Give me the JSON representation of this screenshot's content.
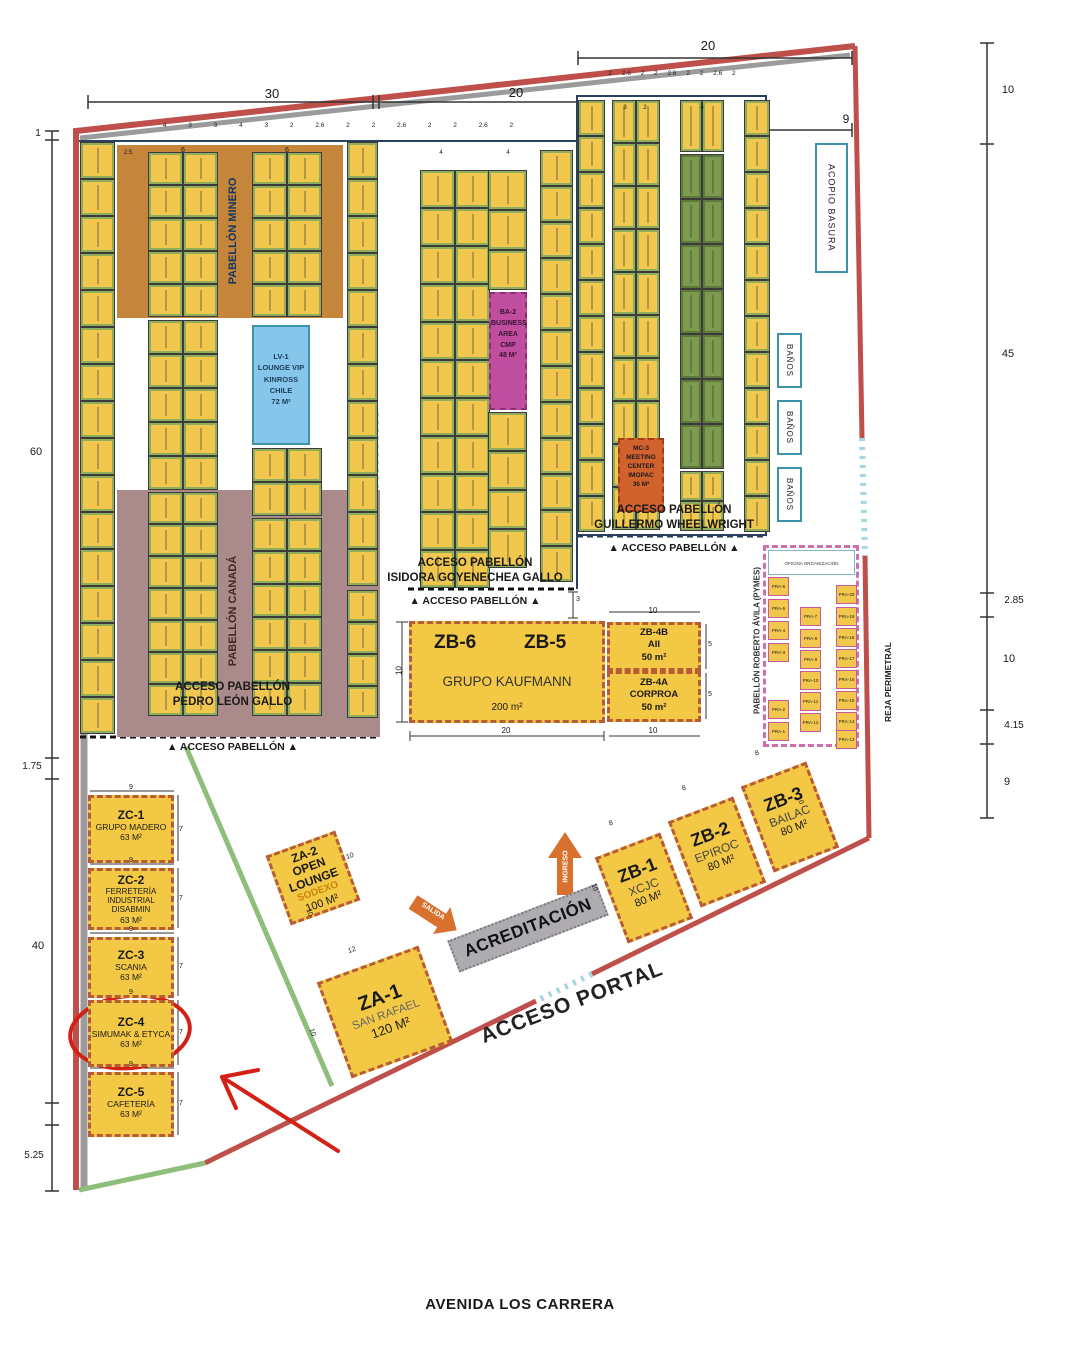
{
  "colors": {
    "perimeter_red": "#bf4f4a",
    "gray_band": "#9b9b9b",
    "green_fence": "#8ebf7a",
    "gate_blue": "#a5d6e4",
    "booth_yellow": "#f1c84d",
    "booth_green": "#7d9b4e",
    "pabellon_minero": "#c5863b",
    "pabellon_canada": "#ab8a8b",
    "lv1_blue": "#85c6ea",
    "ba2_magenta": "#bf4f9e",
    "mc3_orange": "#d2622d",
    "zone_yellow": "#f3c845",
    "zone_border": "#b85c38",
    "pymes_pink": "#d06fae",
    "teal": "#3f93a8",
    "navy": "#2d3f5e",
    "annotation_red": "#d42015",
    "arrow_orange": "#d8702e",
    "banner_gray": "#aeabb1"
  },
  "pavilions": {
    "minero": "PABELLÓN MINERO",
    "canada": "PABELLÓN CANADÁ",
    "pymes_label": "PABELLÓN ROBERTO ÁVILA (PYMES)",
    "pymes_office": "OFICINA ORGANIZACIÓN"
  },
  "blocks": {
    "lv1": "LV-1\nLOUNGE VIP\nKINROSS CHILE\n72 M²",
    "ba2": "BA-2\nBUSINESS\nAREA\nCMP\n48 M²",
    "mc3": "MC-3\nMEETING\nCENTER\nIMOPAC\n36 M²"
  },
  "zones": {
    "zb6": "ZB-6",
    "zb5": "ZB-5",
    "kaufmann_name": "GRUPO KAUFMANN",
    "kaufmann_area": "200 m²",
    "zb4b": "ZB-4B\nAII\n50 m²",
    "zb4a": "ZB-4A\nCORPROA\n50 m²",
    "zb123": [
      {
        "id": "ZB-1",
        "name": "XCJC",
        "area": "80 M²"
      },
      {
        "id": "ZB-2",
        "name": "EPIROC",
        "area": "80 M²"
      },
      {
        "id": "ZB-3",
        "name": "BAILAC",
        "area": "80 M²"
      }
    ],
    "za2": {
      "id": "ZA-2",
      "name": "OPEN\nLOUNGE",
      "brand": "SODEXO",
      "area": "100 M²"
    },
    "za1": {
      "id": "ZA-1",
      "name": "SAN RAFAEL",
      "area": "120 M²"
    },
    "zc": [
      {
        "id": "ZC-1",
        "name": "GRUPO MADERO",
        "area": "63 M²"
      },
      {
        "id": "ZC-2",
        "name": "FERRETERÍA INDUSTRIAL DISABMIN",
        "area": "63 M²"
      },
      {
        "id": "ZC-3",
        "name": "SCANIA",
        "area": "63 M²"
      },
      {
        "id": "ZC-4",
        "name": "SIMUMAK & ETYCA",
        "area": "63 M²"
      },
      {
        "id": "ZC-5",
        "name": "CAFETERÍA",
        "area": "63 M²"
      }
    ]
  },
  "pymes_booths": [
    {
      "id": "PRA-6",
      "x": 768,
      "y": 577
    },
    {
      "id": "PRA-5",
      "x": 768,
      "y": 599
    },
    {
      "id": "PRA-4",
      "x": 768,
      "y": 621
    },
    {
      "id": "PRA-3",
      "x": 768,
      "y": 643
    },
    {
      "id": "PRA-2",
      "x": 768,
      "y": 700
    },
    {
      "id": "PRA-1",
      "x": 768,
      "y": 722
    },
    {
      "id": "PRA-7",
      "x": 800,
      "y": 607
    },
    {
      "id": "PRA-8",
      "x": 800,
      "y": 629
    },
    {
      "id": "PRA-9",
      "x": 800,
      "y": 650
    },
    {
      "id": "PRA-10",
      "x": 800,
      "y": 671
    },
    {
      "id": "PRA-11",
      "x": 800,
      "y": 692
    },
    {
      "id": "PRA-12",
      "x": 800,
      "y": 713
    },
    {
      "id": "PRA-20",
      "x": 836,
      "y": 585
    },
    {
      "id": "PRA-19",
      "x": 836,
      "y": 607
    },
    {
      "id": "PRA-18",
      "x": 836,
      "y": 628
    },
    {
      "id": "PRA-17",
      "x": 836,
      "y": 649
    },
    {
      "id": "PRA-16",
      "x": 836,
      "y": 670
    },
    {
      "id": "PRA-15",
      "x": 836,
      "y": 691
    },
    {
      "id": "PRA-14",
      "x": 836,
      "y": 712
    },
    {
      "id": "PRA-13",
      "x": 836,
      "y": 730
    }
  ],
  "facilities": {
    "acopio": "ACOPIO BASURA",
    "banos": [
      "BAÑOS",
      "BAÑOS",
      "BAÑOS"
    ]
  },
  "accesses": {
    "guillermo": "ACCESO PABELLÓN\nGUILLERMO WHEELWRIGHT",
    "isidora": "ACCESO PABELLÓN\nISIDORA GOYENECHEA GALLO",
    "pedro": "ACCESO PABELLÓN\nPEDRO LEÓN GALLO",
    "marker": "▲ ACCESO PABELLÓN ▲"
  },
  "wayfinding": {
    "acreditacion": "ACREDITACIÓN",
    "salida": "SALIDA",
    "ingreso": "INGRESO",
    "acceso_portal": "ACCESO PORTAL",
    "avenida": "AVENIDA LOS CARRERA",
    "reja": "REJA PERIMETRAL"
  },
  "map": {
    "small_dim_row_left": "4 3 3 4 3 2 2.6 2 2 2.6 2 2 2.6 2",
    "small_dim_row_right": "2 2.6 2 2 2.6 2 2 2.6 2",
    "dim_labels": [
      {
        "t": "30",
        "x": 232,
        "y": 86,
        "fs": 13
      },
      {
        "t": "20",
        "x": 476,
        "y": 85,
        "fs": 13
      },
      {
        "t": "20",
        "x": 668,
        "y": 38,
        "fs": 13
      },
      {
        "t": "9",
        "x": 806,
        "y": 112,
        "fs": 12
      },
      {
        "t": "1",
        "x": -2,
        "y": 128,
        "fs": 10
      },
      {
        "t": "60",
        "x": -4,
        "y": 446,
        "fs": 11
      },
      {
        "t": "1.75",
        "x": -8,
        "y": 761,
        "fs": 10
      },
      {
        "t": "40",
        "x": -2,
        "y": 940,
        "fs": 11
      },
      {
        "t": "5.25",
        "x": -6,
        "y": 1150,
        "fs": 10
      },
      {
        "t": "10",
        "x": 968,
        "y": 84,
        "fs": 11
      },
      {
        "t": "45",
        "x": 968,
        "y": 348,
        "fs": 11
      },
      {
        "t": "2.85",
        "x": 974,
        "y": 595,
        "fs": 10
      },
      {
        "t": "10",
        "x": 969,
        "y": 653,
        "fs": 11
      },
      {
        "t": "4.15",
        "x": 974,
        "y": 720,
        "fs": 10
      },
      {
        "t": "9",
        "x": 967,
        "y": 776,
        "fs": 11
      },
      {
        "t": "2.5",
        "x": 88,
        "y": 150,
        "fs": 6
      },
      {
        "t": "6",
        "x": 143,
        "y": 147,
        "fs": 7
      },
      {
        "t": "6",
        "x": 247,
        "y": 147,
        "fs": 7
      },
      {
        "t": "4",
        "x": 401,
        "y": 150,
        "fs": 6
      },
      {
        "t": "4",
        "x": 468,
        "y": 150,
        "fs": 6
      },
      {
        "t": "3",
        "x": 585,
        "y": 105,
        "fs": 6
      },
      {
        "t": "2",
        "x": 605,
        "y": 105,
        "fs": 6
      },
      {
        "t": "4",
        "x": 662,
        "y": 105,
        "fs": 6
      },
      {
        "t": "3",
        "x": 538,
        "y": 596,
        "fs": 7
      },
      {
        "t": "10",
        "x": 359,
        "y": 666,
        "r": -90,
        "fs": 8
      },
      {
        "t": "20",
        "x": 466,
        "y": 726,
        "fs": 8
      },
      {
        "t": "10",
        "x": 613,
        "y": 606,
        "fs": 8
      },
      {
        "t": "5",
        "x": 670,
        "y": 641,
        "fs": 7
      },
      {
        "t": "5",
        "x": 670,
        "y": 691,
        "fs": 7
      },
      {
        "t": "10",
        "x": 613,
        "y": 726,
        "fs": 8
      },
      {
        "t": "8",
        "x": 571,
        "y": 820,
        "r": -21,
        "fs": 7
      },
      {
        "t": "8",
        "x": 644,
        "y": 785,
        "r": -21,
        "fs": 7
      },
      {
        "t": "8",
        "x": 717,
        "y": 750,
        "r": -21,
        "fs": 7
      },
      {
        "t": "10",
        "x": 554,
        "y": 884,
        "r": 69,
        "fs": 7
      },
      {
        "t": "10",
        "x": 760,
        "y": 797,
        "r": 69,
        "fs": 7
      },
      {
        "t": "10",
        "x": 310,
        "y": 853,
        "r": -20,
        "fs": 7
      },
      {
        "t": "10",
        "x": 269,
        "y": 909,
        "r": 70,
        "fs": 7
      },
      {
        "t": "12",
        "x": 312,
        "y": 947,
        "r": -20,
        "fs": 7
      },
      {
        "t": "10",
        "x": 272,
        "y": 1029,
        "r": 70,
        "fs": 7
      },
      {
        "t": "9",
        "x": 91,
        "y": 784,
        "fs": 7
      },
      {
        "t": "7",
        "x": 141,
        "y": 826,
        "fs": 7
      },
      {
        "t": "9",
        "x": 91,
        "y": 857,
        "fs": 7
      },
      {
        "t": "7",
        "x": 141,
        "y": 895,
        "fs": 7
      },
      {
        "t": "9",
        "x": 91,
        "y": 926,
        "fs": 7
      },
      {
        "t": "7",
        "x": 141,
        "y": 963,
        "fs": 7
      },
      {
        "t": "9",
        "x": 91,
        "y": 989,
        "fs": 7
      },
      {
        "t": "7",
        "x": 141,
        "y": 1029,
        "fs": 7
      },
      {
        "t": "9",
        "x": 91,
        "y": 1061,
        "fs": 7
      },
      {
        "t": "7",
        "x": 141,
        "y": 1100,
        "fs": 7
      }
    ],
    "booth_groups": [
      {
        "x": 80,
        "y": 142,
        "c": 1,
        "r": 16,
        "w": 35,
        "h": 37
      },
      {
        "x": 148,
        "y": 152,
        "c": 2,
        "r": 5,
        "w": 35,
        "h": 33
      },
      {
        "x": 148,
        "y": 320,
        "c": 2,
        "r": 5,
        "w": 35,
        "h": 34
      },
      {
        "x": 148,
        "y": 492,
        "c": 2,
        "r": 7,
        "w": 35,
        "h": 32
      },
      {
        "x": 252,
        "y": 152,
        "c": 2,
        "r": 5,
        "w": 35,
        "h": 33
      },
      {
        "x": 252,
        "y": 448,
        "c": 2,
        "r": 2,
        "w": 35,
        "h": 34
      },
      {
        "x": 252,
        "y": 518,
        "c": 2,
        "r": 6,
        "w": 35,
        "h": 33
      },
      {
        "x": 347,
        "y": 142,
        "c": 1,
        "r": 12,
        "w": 31,
        "h": 37
      },
      {
        "x": 347,
        "y": 590,
        "c": 1,
        "r": 4,
        "w": 31,
        "h": 32
      },
      {
        "x": 420,
        "y": 170,
        "c": 2,
        "r": 11,
        "w": 35,
        "h": 38
      },
      {
        "x": 488,
        "y": 170,
        "c": 1,
        "r": 3,
        "w": 39,
        "h": 40
      },
      {
        "x": 488,
        "y": 412,
        "c": 1,
        "r": 4,
        "w": 39,
        "h": 39
      },
      {
        "x": 540,
        "y": 150,
        "c": 1,
        "r": 12,
        "w": 33,
        "h": 36
      },
      {
        "x": 578,
        "y": 100,
        "c": 1,
        "r": 12,
        "w": 27,
        "h": 36
      },
      {
        "x": 612,
        "y": 100,
        "c": 2,
        "r": 10,
        "w": 24,
        "h": 43
      },
      {
        "x": 680,
        "y": 100,
        "c": 2,
        "r": 1,
        "w": 22,
        "h": 52
      },
      {
        "x": 680,
        "y": 154,
        "c": 2,
        "r": 7,
        "w": 22,
        "h": 45,
        "f": "g"
      },
      {
        "x": 680,
        "y": 471,
        "c": 2,
        "r": 2,
        "w": 22,
        "h": 30
      },
      {
        "x": 744,
        "y": 100,
        "c": 1,
        "r": 12,
        "w": 26,
        "h": 36
      }
    ]
  }
}
